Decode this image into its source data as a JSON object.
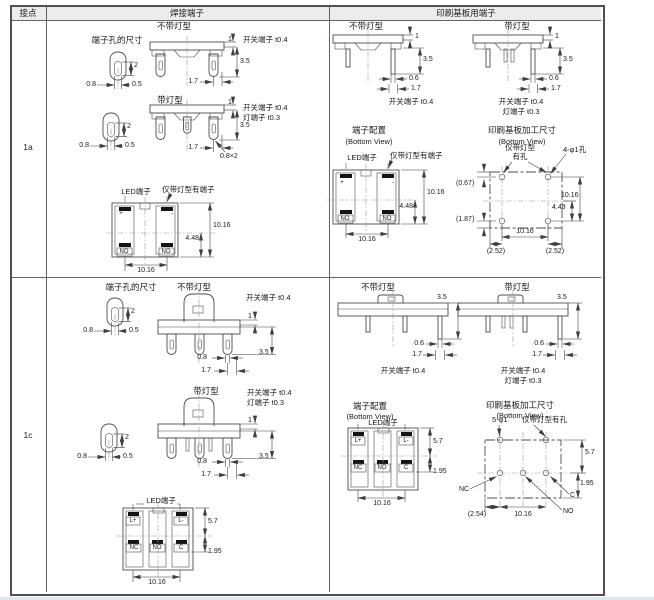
{
  "header": {
    "contact": "接点",
    "solder": "焊接端子",
    "pcb": "印刷基板用端子"
  },
  "rows": {
    "r1a": "1a",
    "r1c": "1c"
  },
  "titles": {
    "noLamp": "不带灯型",
    "lamp": "带灯型",
    "holeSize": "端子孔的尺寸",
    "config": "端子配置",
    "bottomView": "(Bottom View)",
    "pcbDims": "印刷基板加工尺寸"
  },
  "notes": {
    "switchTerm": "开关端子 t0.4",
    "lampTerm": "灯端子 t0.3",
    "ledTerm": "LED端子",
    "lampOnlyTerm": "仅带灯型有端子",
    "lampOnly1": "仅带灯型",
    "lampOnly2": "有孔",
    "lampOnlyHole": "仅带灯型有孔",
    "holes4": "4-φ1孔",
    "holes5": "5-φ1"
  },
  "dims": {
    "v1": "1",
    "v2": "2",
    "v05": "0.5",
    "v06": "0.6",
    "v08": "0.8",
    "v08x2": "0.8×2",
    "v17": "1.7",
    "v35": "3.5",
    "v448": "4.48",
    "v57": "5.7",
    "v195": "1.95",
    "v1016": "10.16",
    "p067": "(0.67)",
    "p187": "(1.87)",
    "p252": "(2.52)",
    "p254": "(2.54)"
  },
  "terminals": {
    "no": "NO",
    "nc": "NC",
    "c": "C",
    "lp": "L+",
    "lm": "L-",
    "plus": "+",
    "minus": "-"
  },
  "colors": {
    "border": "#564c51",
    "headerBg": "#ececec",
    "line": "#4d4d4d"
  }
}
